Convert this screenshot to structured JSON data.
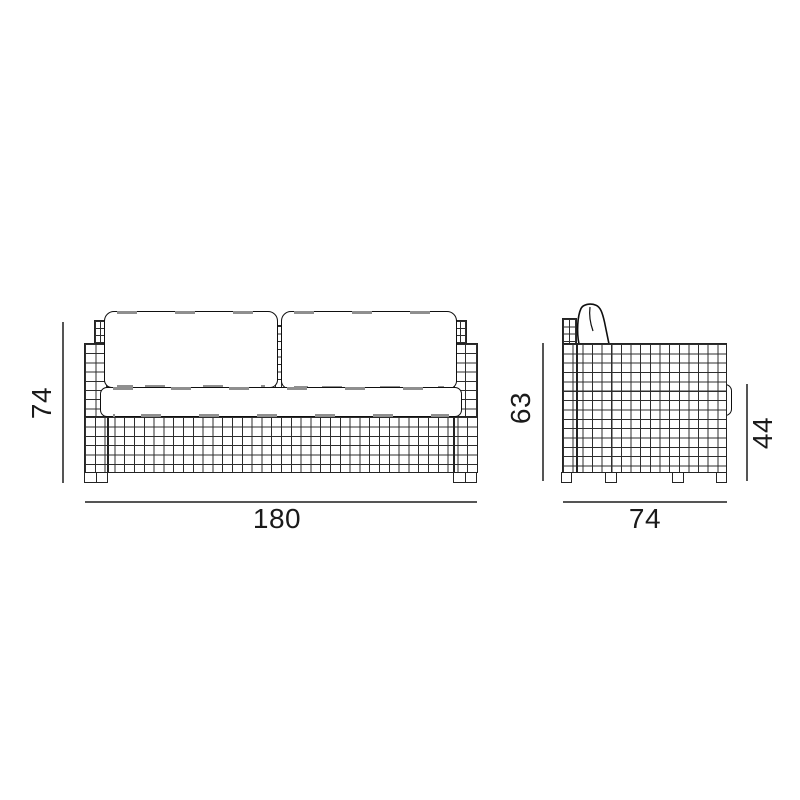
{
  "diagram": {
    "type": "furniture-technical-drawing",
    "subject": "two-seat wicker sofa, front and side elevations with dimensions",
    "colors": {
      "background": "#ffffff",
      "grid_line": "#2e2e2e",
      "outline": "#0f0f0f",
      "dimension_line": "#555555",
      "stitch_dash": "#8f8f8f",
      "text": "#1a1a1a"
    },
    "front_view": {
      "name": "front elevation",
      "dim_height": "74",
      "dim_width": "180"
    },
    "side_view": {
      "name": "side elevation",
      "dim_back_height": "63",
      "dim_seat_height": "44",
      "dim_depth": "74"
    }
  }
}
